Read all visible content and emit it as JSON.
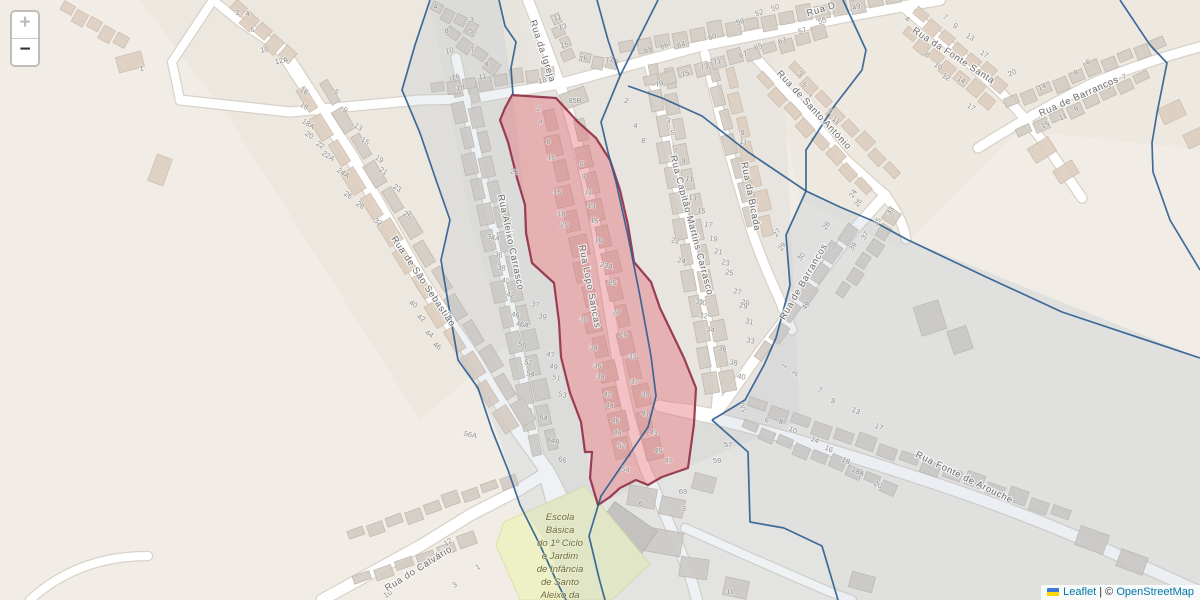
{
  "controls": {
    "zoom_in": "+",
    "zoom_out": "−"
  },
  "attribution": {
    "flag_icon": "ukraine-flag-icon",
    "leaflet": "Leaflet",
    "separator": "|",
    "copyright": "©",
    "osm": "OpenStreetMap"
  },
  "map": {
    "colors": {
      "base": "#f1ede6",
      "highlight_fill": "#e4636f",
      "highlight_stroke": "#8c2440",
      "boundary": "#2c5d8f",
      "school_fill": "#eef0c6",
      "street_label": "#6b6b6b",
      "house_number": "#8d8d8d",
      "school_label": "#6a6a44"
    },
    "street_labels": [
      {
        "text": "Rua da Igreja",
        "x": 540,
        "y": 52,
        "angle": 72
      },
      {
        "text": "Rua Lopo Sancas",
        "x": 587,
        "y": 287,
        "angle": 79
      },
      {
        "text": "Rua Aleixo Carrasco",
        "x": 508,
        "y": 243,
        "angle": 78
      },
      {
        "text": "Rua de São Sebastião",
        "x": 421,
        "y": 283,
        "angle": 56
      },
      {
        "text": "Rua Capitão Martins Carrasco",
        "x": 689,
        "y": 226,
        "angle": 75
      },
      {
        "text": "Rua da Bicada",
        "x": 748,
        "y": 197,
        "angle": 79
      },
      {
        "text": "Rua de Santo António",
        "x": 812,
        "y": 112,
        "angle": 47
      },
      {
        "text": "Rua da Fonte Santa",
        "x": 952,
        "y": 58,
        "angle": 33
      },
      {
        "text": "Rua de Barrancos",
        "x": 1080,
        "y": 99,
        "angle": -24
      },
      {
        "text": "Rua de Barrancos",
        "x": 806,
        "y": 283,
        "angle": -60
      },
      {
        "text": "Rua Fonte de Arouche",
        "x": 963,
        "y": 480,
        "angle": 26
      },
      {
        "text": "Rua do Calvário",
        "x": 420,
        "y": 571,
        "angle": -32
      },
      {
        "text": "Rua D",
        "x": 822,
        "y": 12,
        "angle": -17
      }
    ],
    "school": {
      "x": 560,
      "y_start": 520,
      "line_height": 13,
      "lines": [
        "Escola",
        "Básica",
        "do 1º Ciclo",
        "e Jardim",
        "de Infância",
        "de Santo",
        "Aleixo da"
      ]
    },
    "house_number_groups": [
      {
        "angle": 12,
        "items": [
          [
            538,
            111,
            "2"
          ],
          [
            540,
            124,
            "4"
          ],
          [
            548,
            144,
            "8"
          ],
          [
            551,
            160,
            "10"
          ],
          [
            557,
            194,
            "16"
          ],
          [
            561,
            216,
            "18"
          ],
          [
            564,
            227,
            "20"
          ],
          [
            583,
            322,
            "30"
          ],
          [
            593,
            350,
            "34"
          ],
          [
            597,
            368,
            "36"
          ],
          [
            600,
            379,
            "38"
          ],
          [
            607,
            397,
            "42"
          ],
          [
            609,
            408,
            "44"
          ],
          [
            615,
            423,
            "46"
          ],
          [
            617,
            435,
            "48"
          ],
          [
            621,
            448,
            "52"
          ],
          [
            625,
            472,
            "54"
          ],
          [
            581,
            166,
            "5"
          ],
          [
            583,
            179,
            "9"
          ],
          [
            588,
            194,
            "11"
          ],
          [
            591,
            208,
            "13"
          ],
          [
            594,
            223,
            "15"
          ],
          [
            598,
            243,
            "19"
          ],
          [
            606,
            268,
            "23A"
          ],
          [
            612,
            285,
            "25"
          ],
          [
            616,
            315,
            "27"
          ],
          [
            623,
            337,
            "29"
          ],
          [
            632,
            359,
            "33"
          ],
          [
            634,
            384,
            "37"
          ],
          [
            645,
            397,
            "39"
          ],
          [
            645,
            416,
            "41"
          ],
          [
            653,
            435,
            "43"
          ],
          [
            658,
            453,
            "45"
          ],
          [
            668,
            463,
            "47"
          ],
          [
            514,
            174,
            "23"
          ],
          [
            493,
            240,
            "34A"
          ],
          [
            498,
            257,
            "36"
          ],
          [
            501,
            270,
            "38"
          ],
          [
            505,
            283,
            "40"
          ],
          [
            510,
            297,
            "42"
          ],
          [
            515,
            317,
            "46"
          ],
          [
            522,
            327,
            "46A"
          ],
          [
            522,
            347,
            "50"
          ],
          [
            528,
            365,
            "52"
          ],
          [
            530,
            376,
            "54"
          ],
          [
            470,
            437,
            "56A"
          ],
          [
            535,
            307,
            "37"
          ],
          [
            542,
            319,
            "39"
          ],
          [
            550,
            357,
            "47"
          ],
          [
            553,
            369,
            "49"
          ],
          [
            556,
            380,
            "51"
          ],
          [
            562,
            397,
            "53"
          ],
          [
            543,
            420,
            "64"
          ],
          [
            553,
            443,
            "64A"
          ],
          [
            562,
            462,
            "66"
          ],
          [
            672,
            135,
            "5"
          ],
          [
            675,
            153,
            "7"
          ],
          [
            683,
            163,
            "9"
          ],
          [
            689,
            181,
            "11"
          ],
          [
            692,
            200,
            "13"
          ],
          [
            701,
            213,
            "15"
          ],
          [
            708,
            227,
            "17"
          ],
          [
            713,
            241,
            "19"
          ],
          [
            718,
            254,
            "21"
          ],
          [
            725,
            265,
            "23"
          ],
          [
            729,
            275,
            "25"
          ],
          [
            737,
            294,
            "27"
          ],
          [
            745,
            305,
            "29"
          ],
          [
            699,
            304,
            "30"
          ],
          [
            675,
            243,
            "22"
          ],
          [
            681,
            263,
            "24"
          ],
          [
            742,
            135,
            "9"
          ],
          [
            743,
            144,
            "11"
          ],
          [
            626,
            103,
            "2"
          ],
          [
            635,
            128,
            "4"
          ],
          [
            643,
            143,
            "8"
          ],
          [
            668,
            123,
            "3"
          ],
          [
            702,
            305,
            "30"
          ],
          [
            703,
            318,
            "32"
          ],
          [
            710,
            332,
            "34"
          ],
          [
            722,
            351,
            "36"
          ],
          [
            733,
            365,
            "38"
          ],
          [
            741,
            379,
            "40"
          ],
          [
            743,
            308,
            "29"
          ],
          [
            749,
            324,
            "31"
          ],
          [
            750,
            343,
            "33"
          ],
          [
            742,
            408,
            "2"
          ]
        ]
      },
      {
        "angle": -17,
        "items": [
          [
            649,
            52,
            "68"
          ],
          [
            665,
            48,
            "66"
          ],
          [
            682,
            47,
            "64"
          ],
          [
            713,
            39,
            "60"
          ],
          [
            741,
            24,
            "56"
          ],
          [
            760,
            15,
            "52"
          ],
          [
            776,
            10,
            "50"
          ],
          [
            759,
            49,
            "65"
          ],
          [
            744,
            57,
            "67"
          ],
          [
            718,
            64,
            "71"
          ],
          [
            705,
            69,
            "73"
          ],
          [
            686,
            76,
            "75"
          ],
          [
            660,
            86,
            "79"
          ],
          [
            783,
            43,
            "63"
          ],
          [
            803,
            33,
            "57"
          ],
          [
            823,
            23,
            "55"
          ],
          [
            857,
            9,
            "49"
          ]
        ]
      },
      {
        "angle": 33,
        "items": [
          [
            799,
            76,
            "3"
          ],
          [
            803,
            87,
            "5"
          ],
          [
            808,
            99,
            "7"
          ],
          [
            906,
            21,
            "4"
          ],
          [
            944,
            19,
            "7"
          ],
          [
            954,
            28,
            "9"
          ],
          [
            969,
            39,
            "13"
          ],
          [
            983,
            56,
            "17"
          ],
          [
            926,
            57,
            "8"
          ],
          [
            937,
            68,
            "10"
          ],
          [
            945,
            79,
            "12"
          ],
          [
            960,
            82,
            "14"
          ],
          [
            970,
            109,
            "17"
          ],
          [
            829,
            113,
            "9"
          ],
          [
            835,
            122,
            "11"
          ]
        ]
      },
      {
        "angle": -24,
        "items": [
          [
            1013,
            75,
            "20"
          ],
          [
            1043,
            89,
            "14"
          ],
          [
            1077,
            75,
            "8"
          ],
          [
            1089,
            64,
            "6"
          ],
          [
            1110,
            89,
            "3"
          ],
          [
            1125,
            79,
            "7"
          ],
          [
            1077,
            111,
            "9"
          ],
          [
            1064,
            119,
            "11"
          ],
          [
            1046,
            127,
            "15"
          ]
        ]
      },
      {
        "angle": 24,
        "items": [
          [
            743,
            412,
            "2"
          ],
          [
            766,
            422,
            "6"
          ],
          [
            780,
            424,
            "8"
          ],
          [
            792,
            432,
            "10"
          ],
          [
            814,
            442,
            "14"
          ],
          [
            828,
            451,
            "16"
          ],
          [
            845,
            463,
            "18"
          ],
          [
            857,
            474,
            "18A"
          ],
          [
            877,
            487,
            "20"
          ],
          [
            819,
            392,
            "7"
          ],
          [
            832,
            403,
            "9"
          ],
          [
            855,
            413,
            "13"
          ],
          [
            878,
            429,
            "17"
          ]
        ]
      },
      {
        "angle": -55,
        "items": [
          [
            855,
            195,
            "24"
          ],
          [
            860,
            204,
            "26"
          ],
          [
            779,
            234,
            "27"
          ],
          [
            828,
            227,
            "28"
          ],
          [
            784,
            248,
            "29"
          ],
          [
            803,
            258,
            "30"
          ],
          [
            892,
            212,
            "33"
          ],
          [
            879,
            223,
            "35"
          ],
          [
            867,
            237,
            "37"
          ],
          [
            855,
            248,
            "39"
          ],
          [
            808,
            307,
            "49"
          ],
          [
            786,
            367,
            "1"
          ],
          [
            797,
            375,
            "3"
          ]
        ]
      },
      {
        "angle": 33,
        "items": [
          [
            303,
            93,
            "16"
          ],
          [
            303,
            108,
            "18"
          ],
          [
            307,
            126,
            "18A"
          ],
          [
            308,
            137,
            "20"
          ],
          [
            319,
            147,
            "22"
          ],
          [
            327,
            158,
            "22A"
          ],
          [
            342,
            175,
            "24A"
          ],
          [
            347,
            197,
            "26"
          ],
          [
            359,
            207,
            "28"
          ],
          [
            377,
            224,
            "32"
          ],
          [
            335,
            94,
            "5"
          ],
          [
            344,
            112,
            "9"
          ],
          [
            357,
            129,
            "13"
          ],
          [
            364,
            143,
            "15"
          ],
          [
            378,
            161,
            "19"
          ],
          [
            382,
            173,
            "21"
          ],
          [
            396,
            190,
            "23"
          ],
          [
            406,
            217,
            "25"
          ],
          [
            412,
            306,
            "40"
          ],
          [
            420,
            320,
            "42"
          ],
          [
            428,
            336,
            "44"
          ],
          [
            436,
            348,
            "46"
          ]
        ]
      },
      {
        "angle": -12,
        "items": [
          [
            238,
            15,
            "2"
          ],
          [
            248,
            16,
            "4"
          ],
          [
            253,
            32,
            "6"
          ],
          [
            265,
            52,
            "10"
          ],
          [
            282,
            63,
            "12A"
          ],
          [
            142,
            71,
            "1"
          ],
          [
            436,
            9,
            "4"
          ],
          [
            472,
            22,
            "3"
          ],
          [
            472,
            33,
            "5"
          ],
          [
            447,
            33,
            "8"
          ],
          [
            450,
            53,
            "10"
          ],
          [
            473,
            52,
            "7"
          ],
          [
            487,
            67,
            "9"
          ],
          [
            456,
            79,
            "16"
          ],
          [
            483,
            79,
            "11"
          ],
          [
            461,
            90,
            "18"
          ],
          [
            558,
            20,
            "11"
          ],
          [
            563,
            29,
            "13"
          ],
          [
            565,
            47,
            "15"
          ],
          [
            584,
            61,
            "76"
          ],
          [
            610,
            62,
            "72"
          ],
          [
            543,
            83,
            "18"
          ]
        ]
      },
      {
        "angle": -30,
        "items": [
          [
            449,
            544,
            "12"
          ],
          [
            440,
            558,
            "14"
          ],
          [
            479,
            569,
            "1"
          ],
          [
            456,
            587,
            "3"
          ],
          [
            389,
            596,
            "10"
          ]
        ]
      },
      {
        "angle": 0,
        "items": [
          [
            575,
            103,
            "85B"
          ],
          [
            728,
            447,
            "57"
          ],
          [
            717,
            463,
            "59"
          ],
          [
            683,
            494,
            "69"
          ],
          [
            684,
            511,
            "3"
          ],
          [
            641,
            506,
            "6"
          ],
          [
            730,
            594,
            "11"
          ]
        ]
      }
    ]
  }
}
